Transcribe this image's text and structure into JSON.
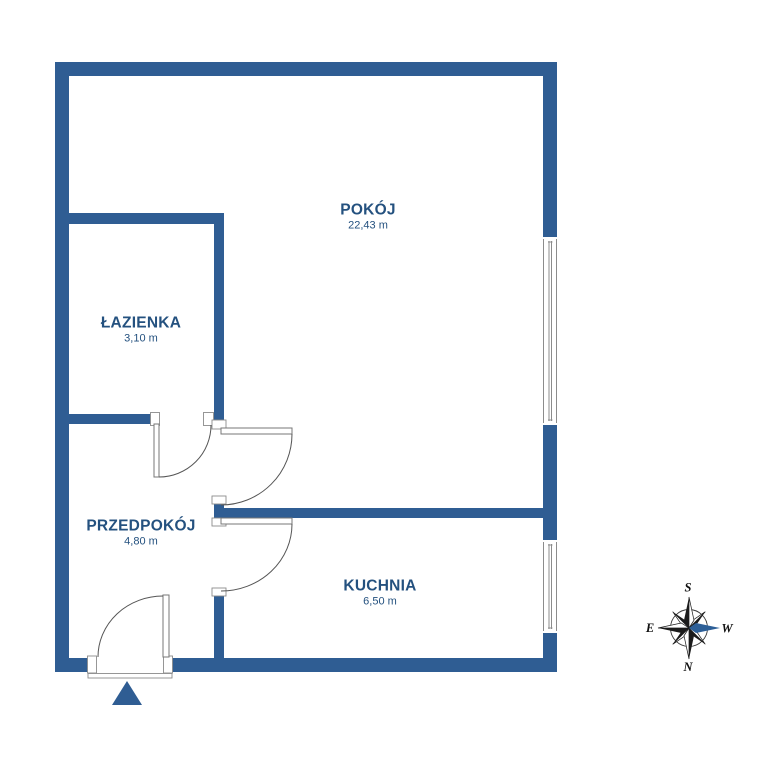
{
  "rooms": [
    {
      "name": "POKÓJ",
      "area": "22,43 m"
    },
    {
      "name": "ŁAZIENKA",
      "area": "3,10 m"
    },
    {
      "name": "PRZEDPOKÓJ",
      "area": "4,80 m"
    },
    {
      "name": "KUCHNIA",
      "area": "6,50 m"
    }
  ],
  "compass": {
    "top": "S",
    "bottom": "N",
    "left": "E",
    "right": "W",
    "highlighted_direction": "W"
  },
  "colors": {
    "wall": "#2f5d93",
    "label": "#24517f",
    "line": "#8c8c8c",
    "door_arc": "#555555",
    "compass_dark": "#1b1b1b",
    "compass_highlight": "#2d5f97"
  }
}
